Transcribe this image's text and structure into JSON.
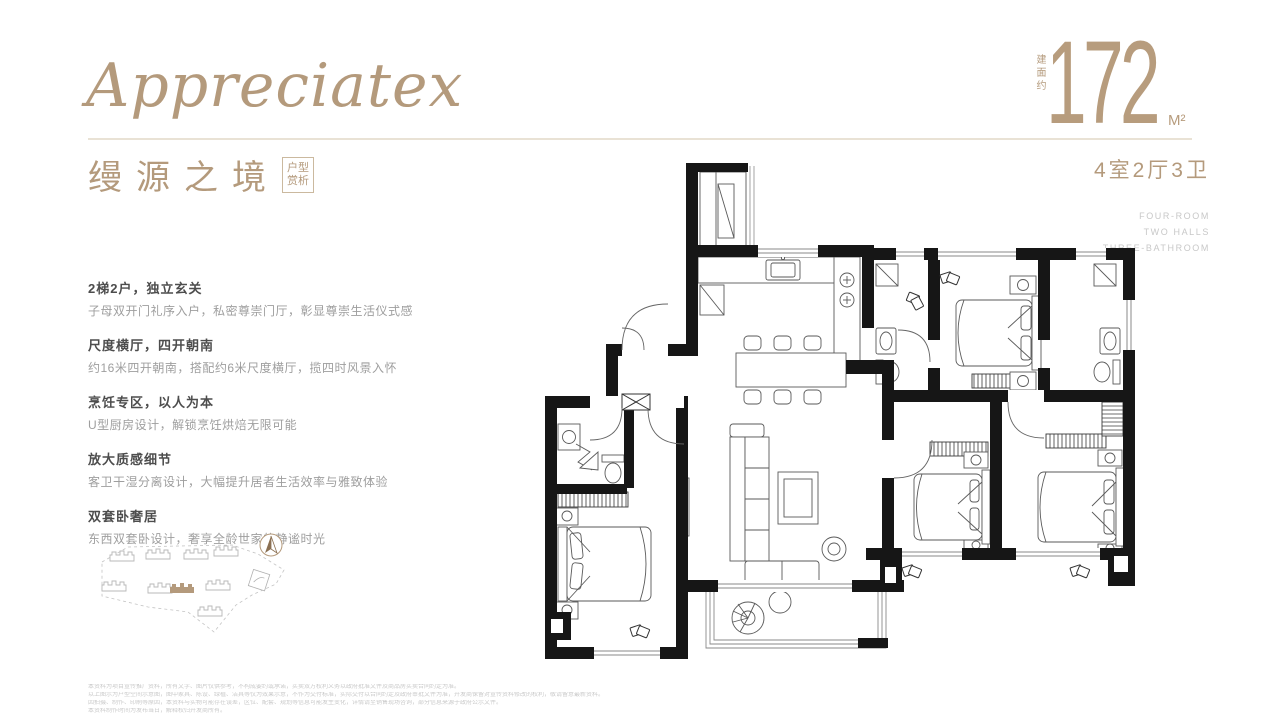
{
  "brand": {
    "script": "Appreciatex"
  },
  "title": {
    "cn": "缦源之境",
    "badge": [
      "户型",
      "赏析"
    ]
  },
  "area": {
    "label": "建面约",
    "value": "172",
    "unit": "M²"
  },
  "meta": {
    "rooms": "4室2厅3卫",
    "en": [
      "FOUR-ROOM",
      "TWO HALLS",
      "THREE-BATHROOM"
    ]
  },
  "features": [
    {
      "heading": "2梯2户，独立玄关",
      "body": "子母双开门礼序入户，私密尊崇门厅，彰显尊崇生活仪式感"
    },
    {
      "heading": "尺度横厅，四开朝南",
      "body": "约16米四开朝南，搭配约6米尺度横厅，揽四时风景入怀"
    },
    {
      "heading": "烹饪专区，以人为本",
      "body": "U型厨房设计，解锁烹饪烘焙无限可能"
    },
    {
      "heading": "放大质感细节",
      "body": "客卫干湿分离设计，大幅提升居者生活效率与雅致体验"
    },
    {
      "heading": "双套卧奢居",
      "body": "东西双套卧设计，奢享全龄世家的静谧时光"
    }
  ],
  "disclaimer": {
    "lines": [
      "本资料为项目宣传推广资料，所有文字、图片仅供参考，不构成要约或承诺，买卖双方权利义务以政府批准文件及商品房买卖合同约定为准。",
      "以上图示为户型空间示意图，图中家具、陈设、绿植、洁具等仅为效果示意，不作为交付标准，实际交付以合同约定及政府审批文件为准，开发商保留对宣传资料修改的权利，敬请留意最新资料。",
      "因拍摄、制作、印刷等原因，本资料与实物可能存在误差，区位、配套、规划等信息可能发生变化，详情请至销售现场咨询，部分信息来源于政府公示文件。",
      "本资料制作时间为发布当日，解释权归开发商所有。"
    ]
  },
  "colors": {
    "accent": "#b49a7c",
    "wall": "#161616",
    "heading_text": "#4d4d4d",
    "body_text": "#9e9e9e",
    "divider": "#e9e2d5"
  }
}
